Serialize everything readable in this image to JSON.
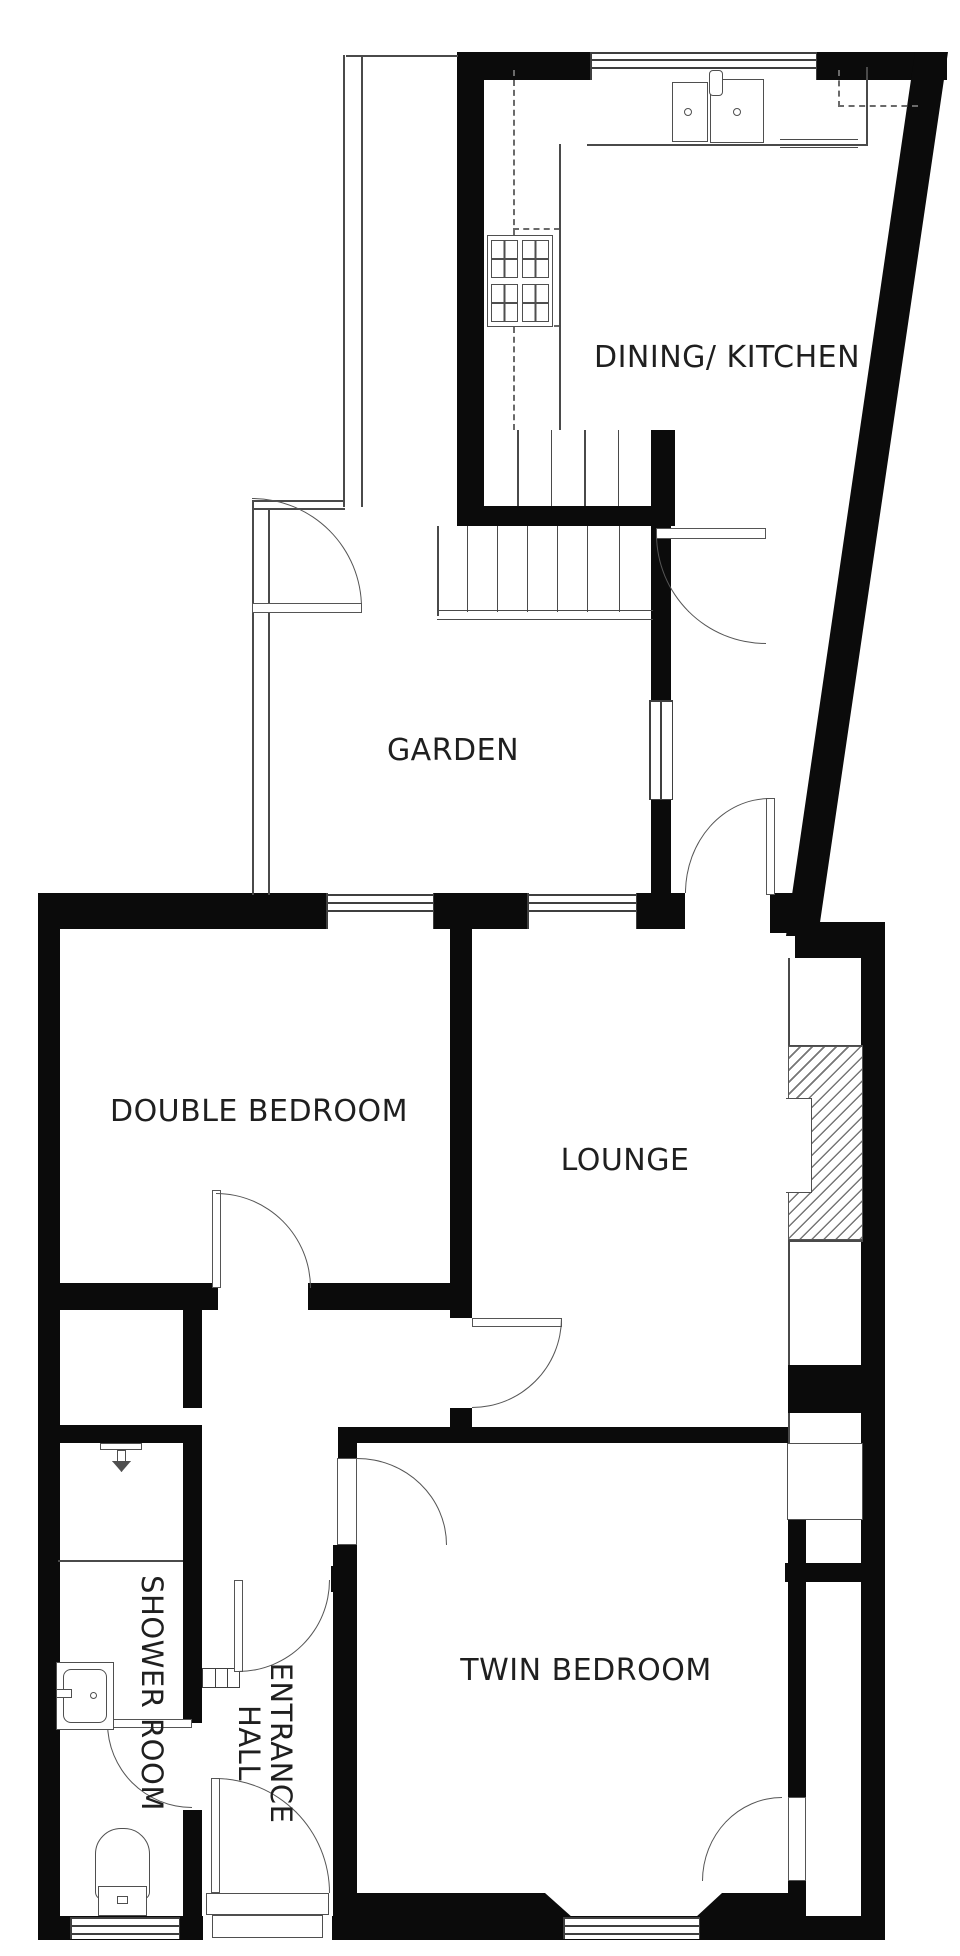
{
  "plan": {
    "background": "#ffffff",
    "wall_color": "#0b0b0b",
    "line_color": "#555555",
    "rooms": {
      "dining_kitchen": {
        "label": "DINING/ KITCHEN"
      },
      "garden": {
        "label": "GARDEN"
      },
      "double_bedroom": {
        "label": "DOUBLE BEDROOM"
      },
      "lounge": {
        "label": "LOUNGE"
      },
      "twin_bedroom": {
        "label": "TWIN BEDROOM"
      },
      "shower_room": {
        "label": "SHOWER ROOM"
      },
      "entrance_hall": {
        "label": "ENTRANCE HALL"
      }
    }
  }
}
